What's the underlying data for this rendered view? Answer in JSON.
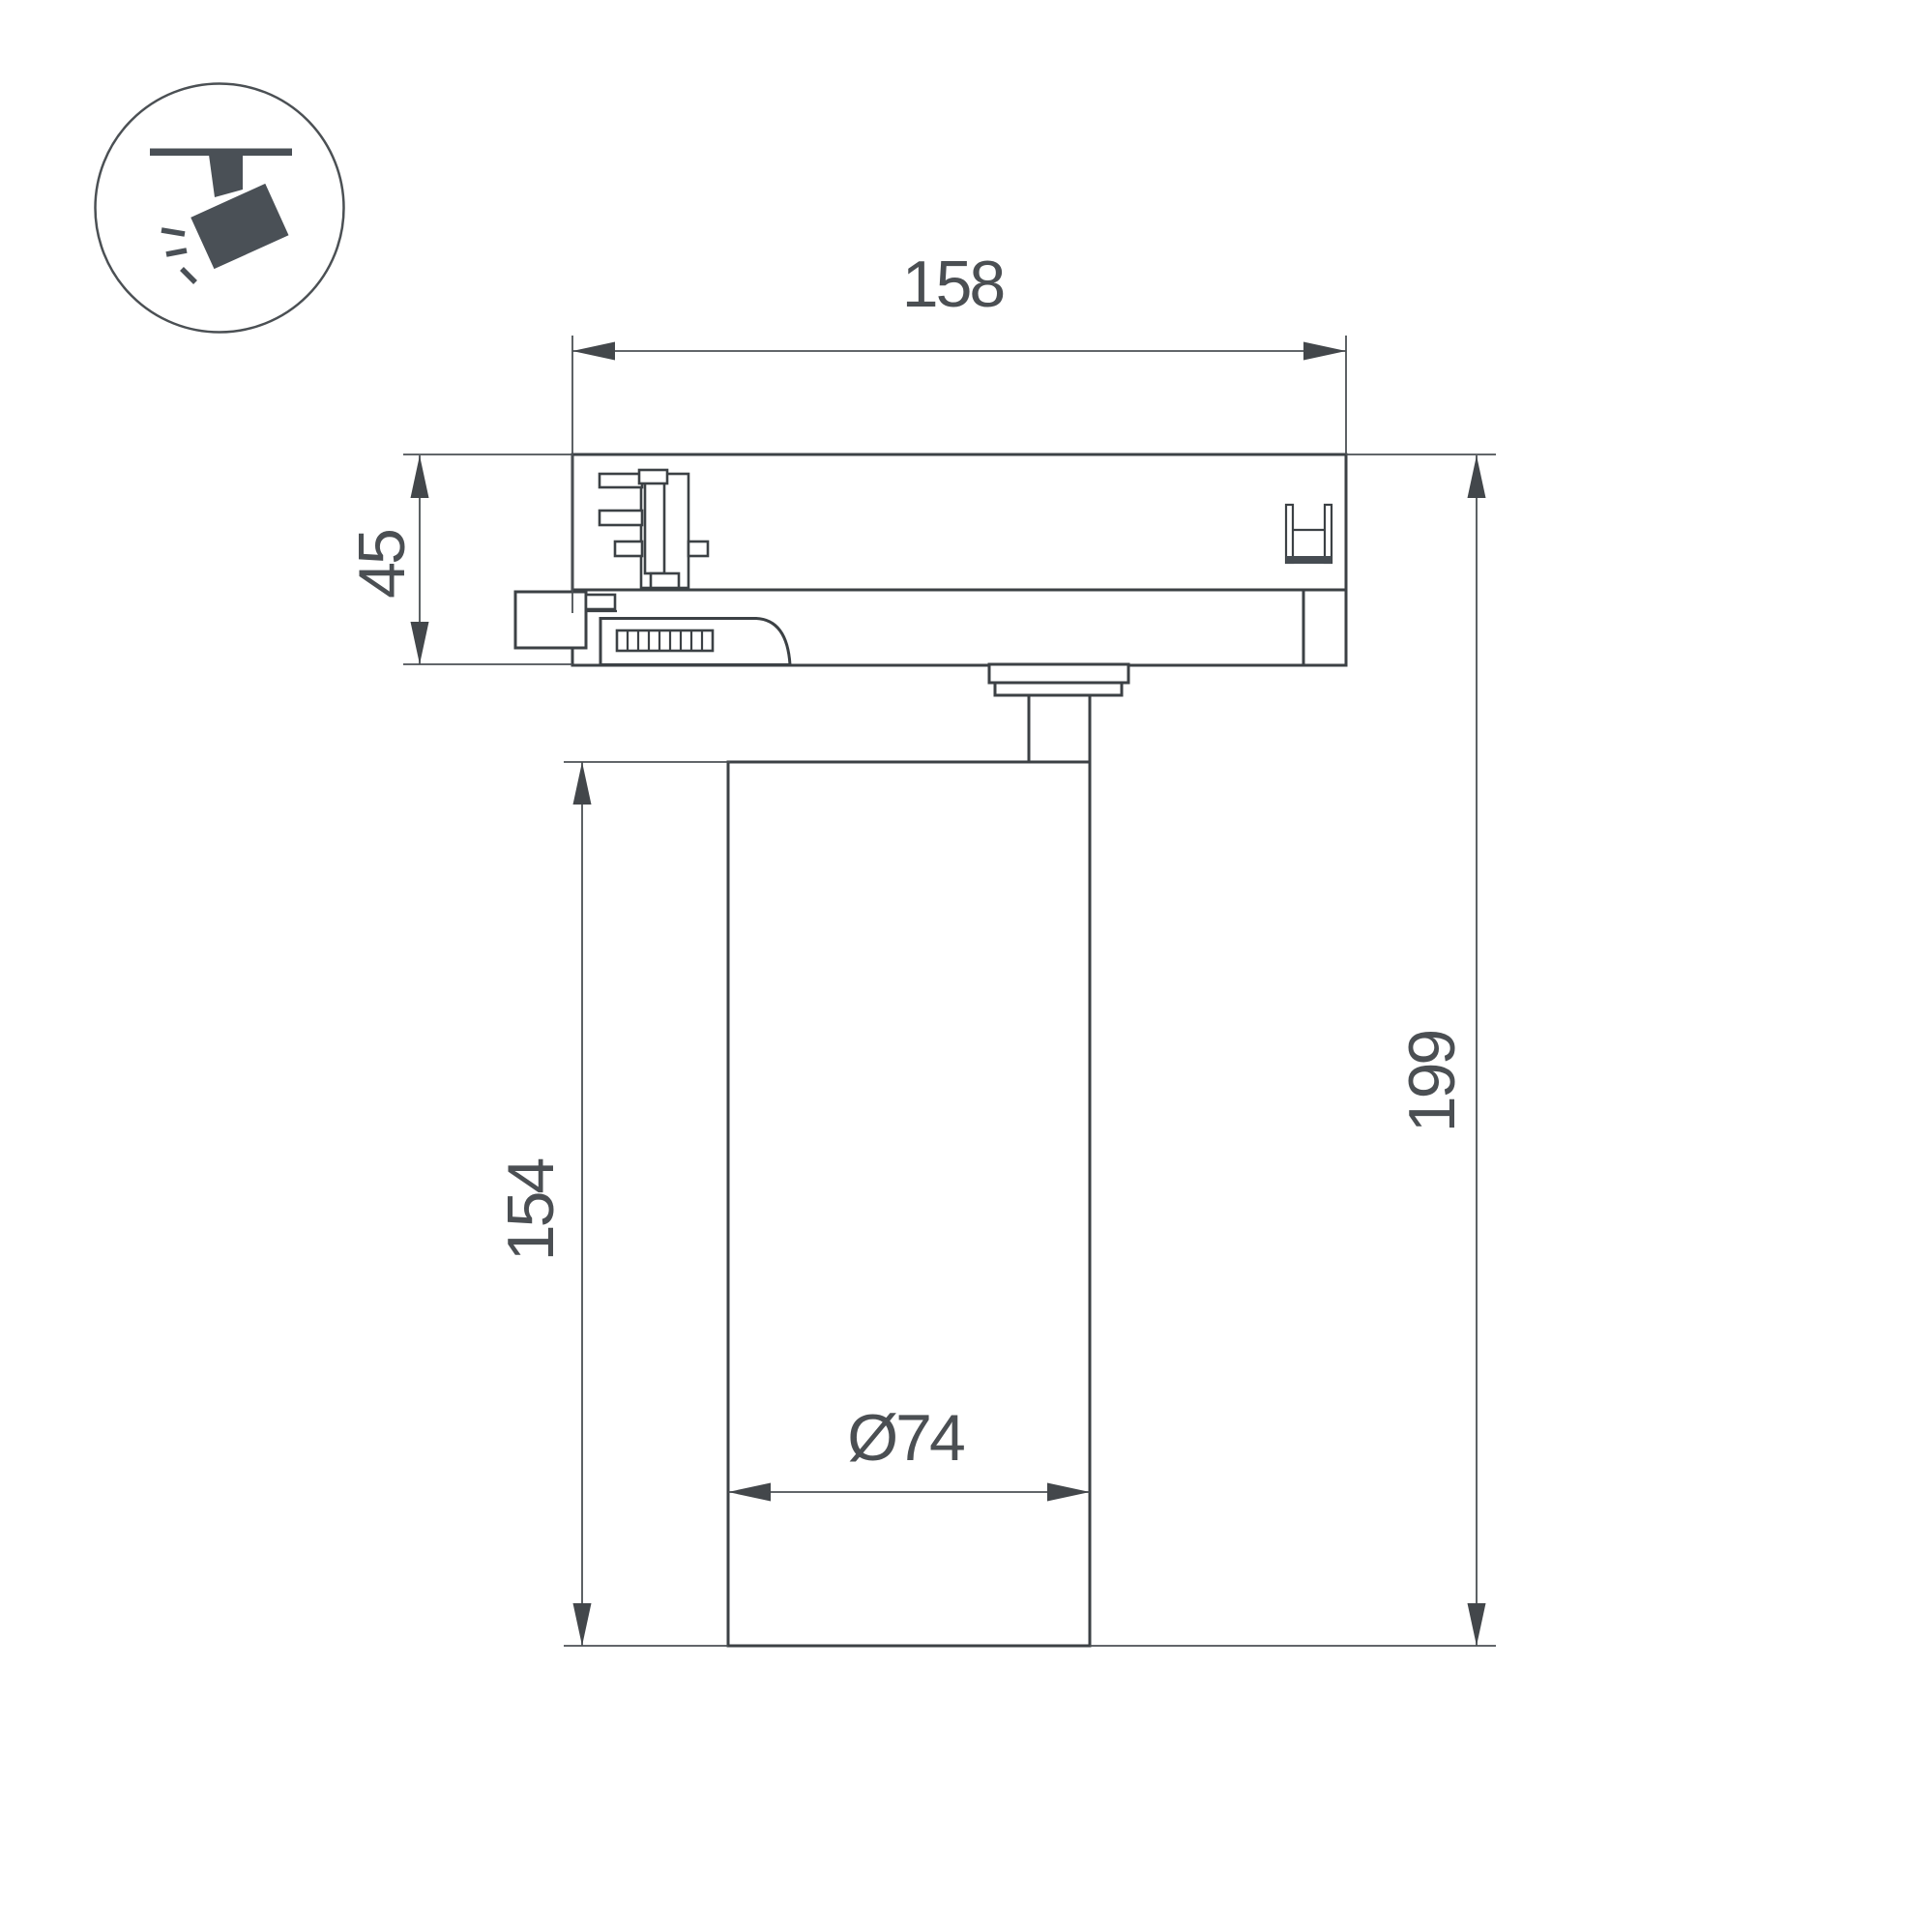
{
  "drawing": {
    "type": "technical-dimension-drawing",
    "subject": "LED track spotlight side view",
    "icon": "track-spotlight-icon",
    "dimensions": {
      "adapter_width": "158",
      "adapter_height": "45",
      "body_height": "154",
      "total_height": "199",
      "body_diameter": "Ø74"
    },
    "colors": {
      "background": "#ffffff",
      "outline": "#3c4145",
      "dimension_line": "#4b5054",
      "text": "#4b4f53",
      "icon_fill": "#4a5056"
    }
  }
}
